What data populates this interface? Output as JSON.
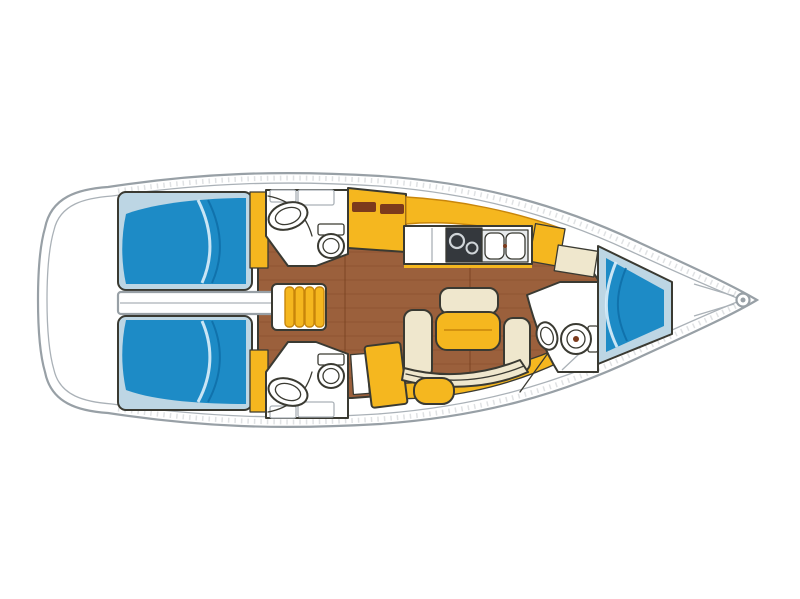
{
  "diagram": {
    "type": "sailboat-interior-floor-plan",
    "orientation": "bow-right-stern-left"
  },
  "colors": {
    "background": "#ffffff",
    "hull_line": "#98a0a6",
    "hull_inner_line": "#aab1b7",
    "outline_dark": "#3a3a32",
    "wood_floor": "#9b603c",
    "wood_plank_line": "#77411f",
    "berth_blue": "#1d8bc6",
    "berth_blue_shadow": "#0f6fa8",
    "berth_highlight": "#ddeef9",
    "cabin_light_blue": "#bdd6e4",
    "joinery_yellow": "#f5b71f",
    "joinery_yellow_shadow": "#c8860b",
    "upholstery_cream": "#efe7cd",
    "fixture_white": "#ffffff",
    "fixture_gray": "#e7eaec",
    "stove_dark": "#34383d",
    "locker_slot_brown": "#7c3a1c"
  }
}
